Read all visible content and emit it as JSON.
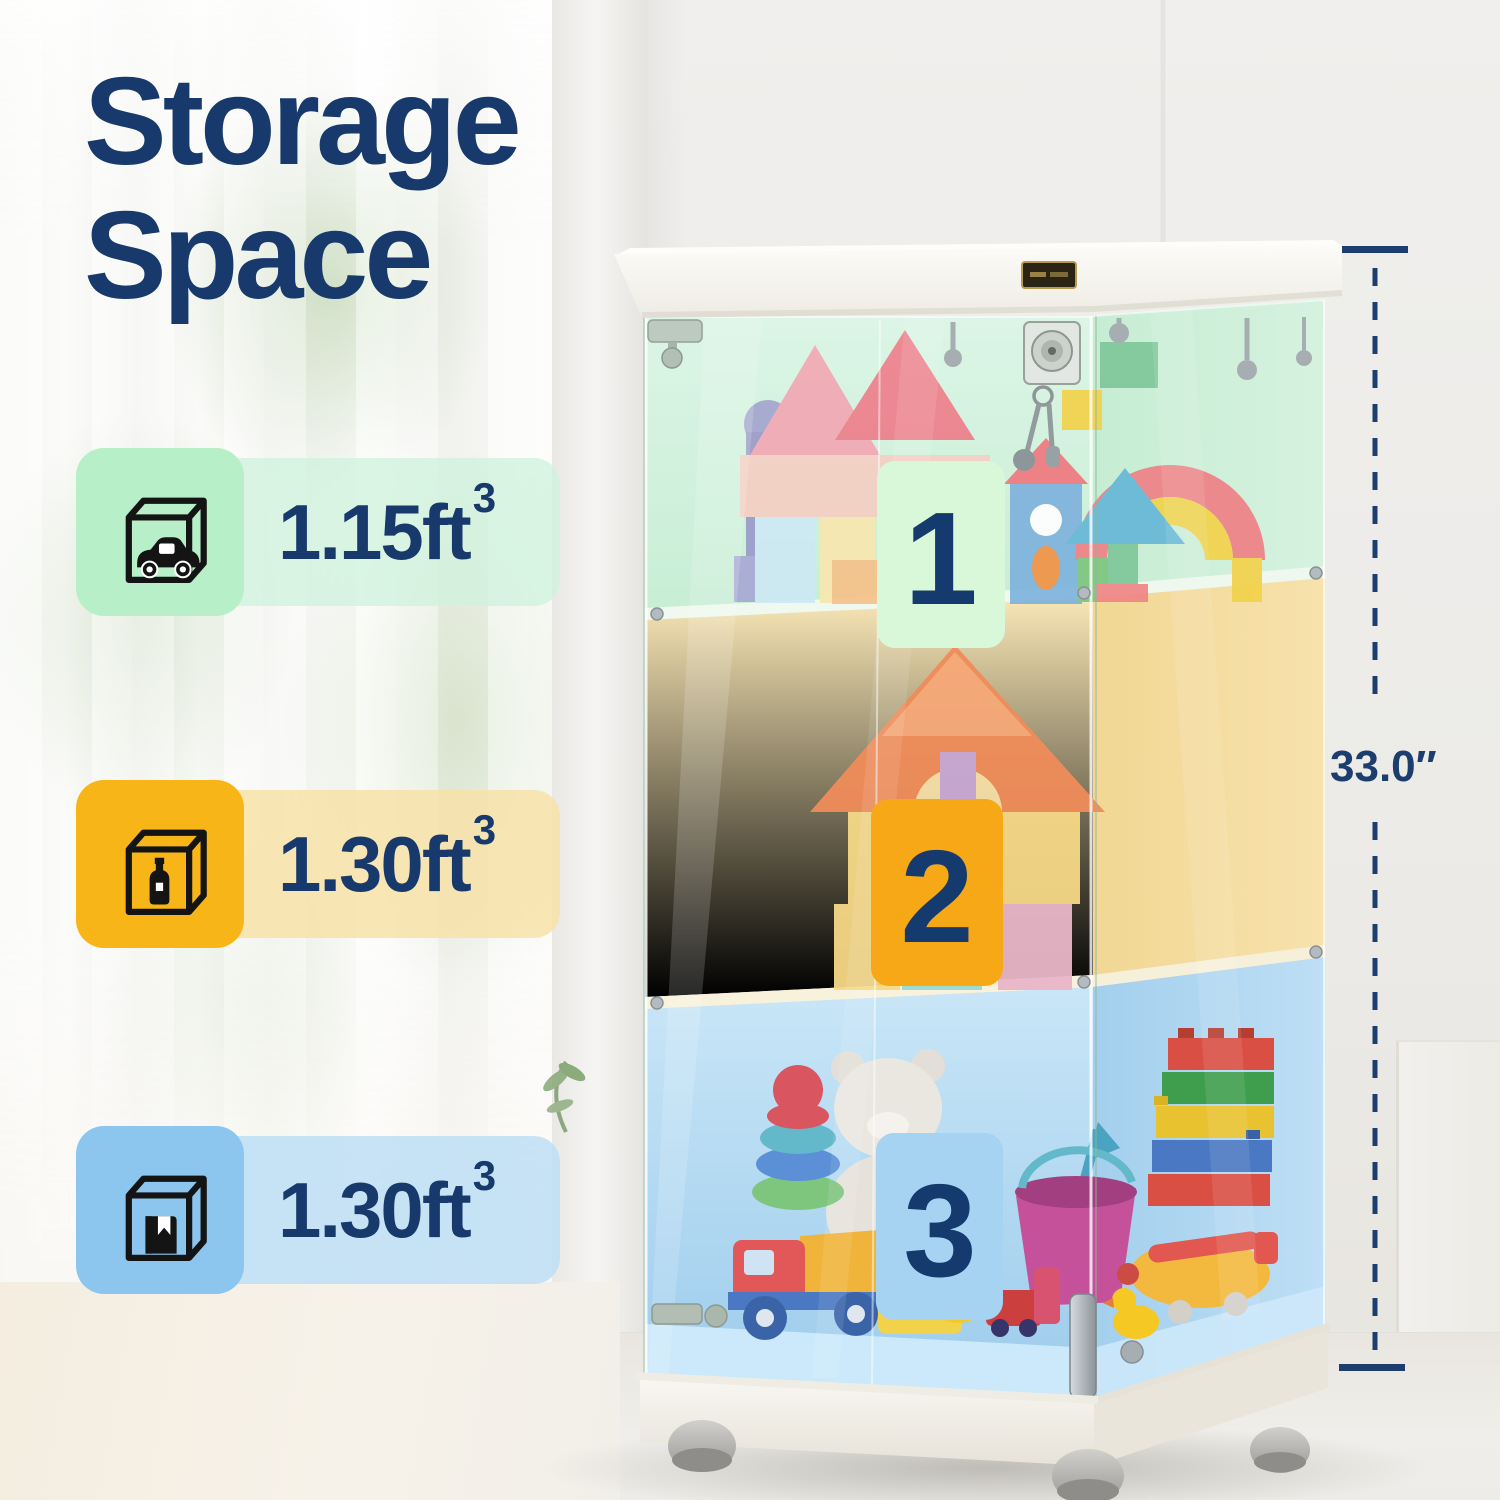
{
  "title": {
    "line1": "Storage",
    "line2": "Space"
  },
  "specs": [
    {
      "icon": "cube-with-car-icon",
      "value": "1.15",
      "unit": "ft",
      "exponent": "3",
      "tile_color": "#b7efc9",
      "band_color": "#d0f2dd",
      "badge_number": "1",
      "badge_color": "#d9f8da"
    },
    {
      "icon": "cube-with-bottle-icon",
      "value": "1.30",
      "unit": "ft",
      "exponent": "3",
      "tile_color": "#f8b517",
      "band_color": "#f7e2a8",
      "badge_number": "2",
      "badge_color": "#f7a816"
    },
    {
      "icon": "cube-with-book-icon",
      "value": "1.30",
      "unit": "ft",
      "exponent": "3",
      "tile_color": "#8cc6ee",
      "band_color": "#bddef4",
      "badge_number": "3",
      "badge_color": "#a6d3f2"
    }
  ],
  "dimension": {
    "height_label": "33.0″",
    "line_color": "#1c3e6e"
  },
  "colors": {
    "accent_navy": "#17396b",
    "tier_green_tint": "#cdeeda",
    "tier_yellow_tint": "#f8e3ad",
    "tier_blue_tint": "#b7dcf3",
    "cabinet_frame": "#f7f5f0"
  }
}
